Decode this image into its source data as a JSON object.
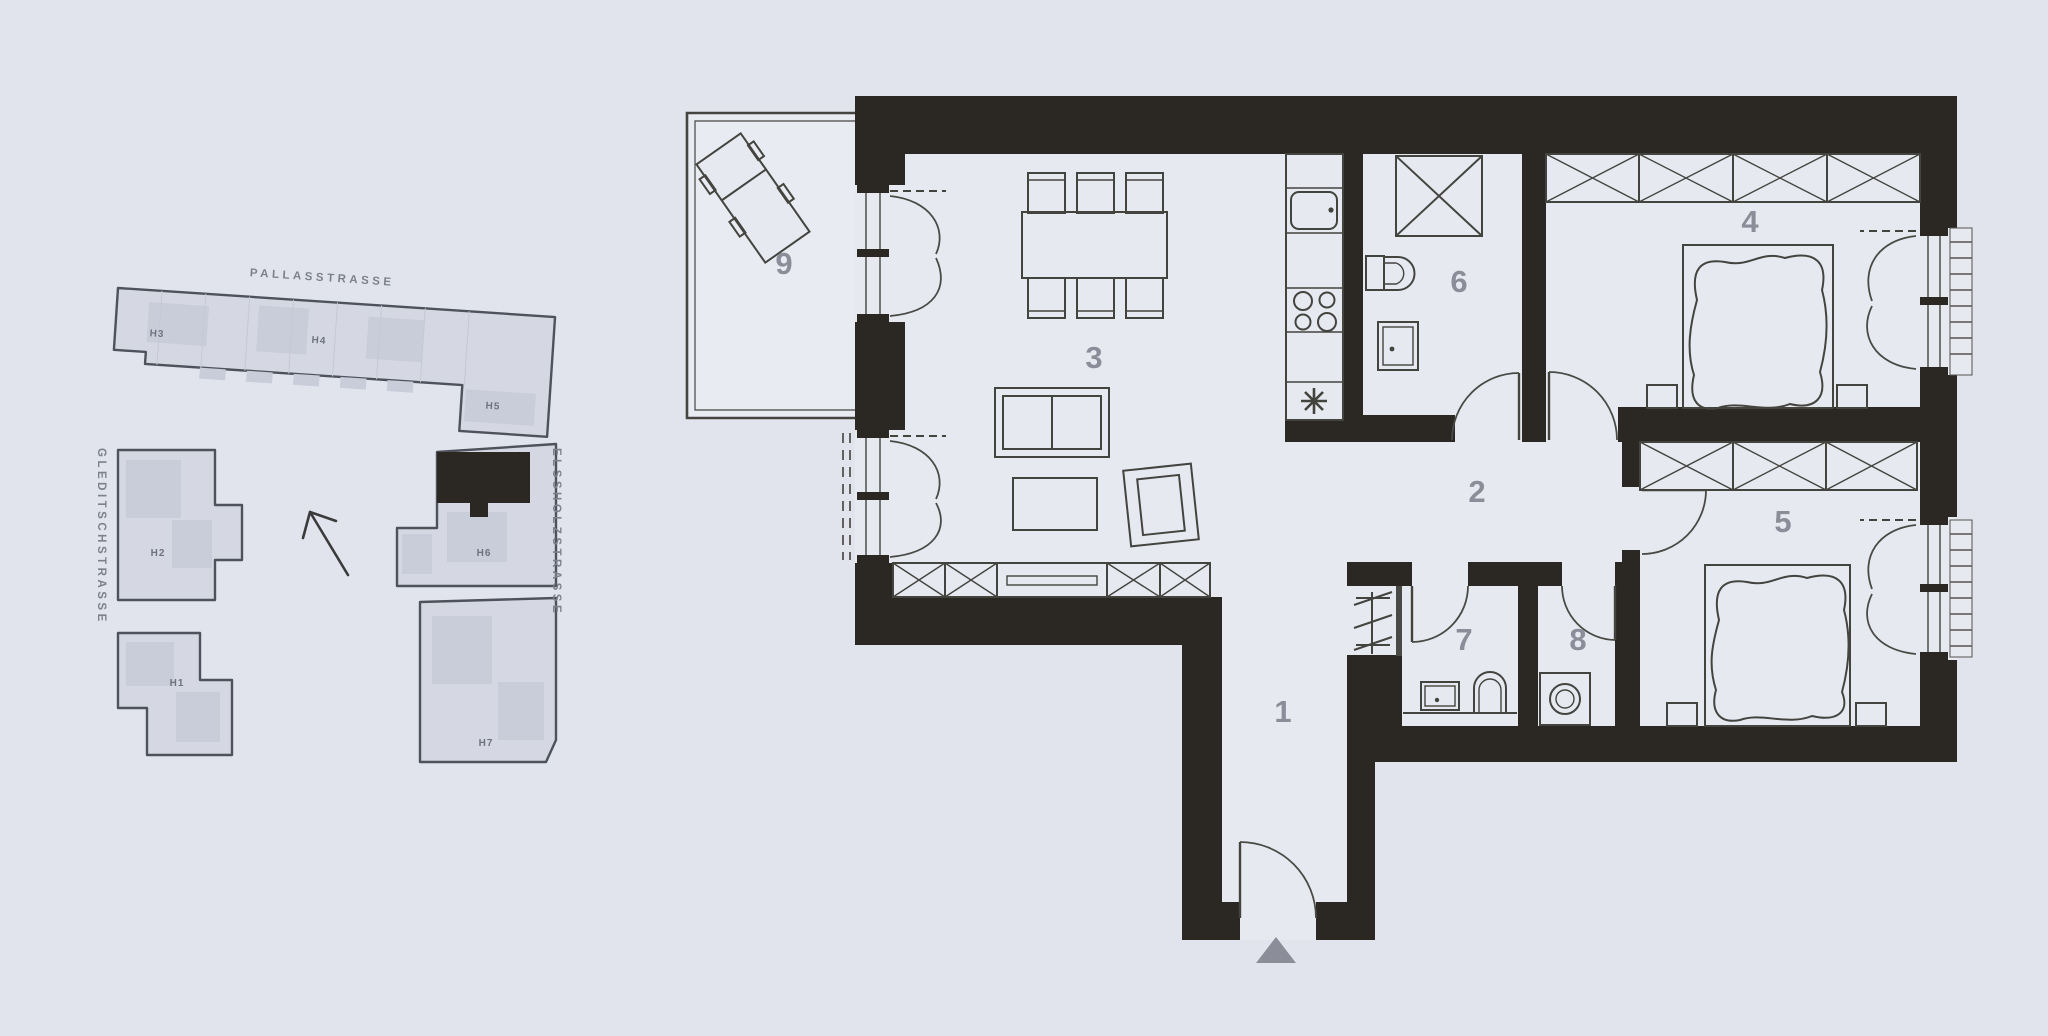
{
  "site_plan": {
    "streets": {
      "top": "PALLASSTRASSE",
      "left": "GLEDITSCHSTRASSE",
      "right": "ELSSHOLZSTRASSE"
    },
    "buildings": [
      {
        "label": "H1"
      },
      {
        "label": "H2"
      },
      {
        "label": "H3"
      },
      {
        "label": "H4"
      },
      {
        "label": "H5"
      },
      {
        "label": "H6"
      },
      {
        "label": "H7"
      }
    ],
    "highlighted_building": "H6",
    "north_arrow_direction": "up-left"
  },
  "floor_plan": {
    "rooms": [
      {
        "number": "1",
        "type": "entrance-hall"
      },
      {
        "number": "2",
        "type": "hallway"
      },
      {
        "number": "3",
        "type": "living-dining"
      },
      {
        "number": "4",
        "type": "bedroom"
      },
      {
        "number": "5",
        "type": "bedroom"
      },
      {
        "number": "6",
        "type": "bathroom"
      },
      {
        "number": "7",
        "type": "wc"
      },
      {
        "number": "8",
        "type": "utility-room"
      },
      {
        "number": "9",
        "type": "balcony"
      }
    ]
  },
  "colors": {
    "background": "#e2e4ed",
    "floor": "#e7e9f1",
    "wall": "#2b2722",
    "furniture_line": "#44443f",
    "label": "#8b8e99",
    "site_fill": "#d5d8e2",
    "site_outline": "#4d525b",
    "site_text": "#7d818c",
    "highlight": "#2b2722"
  }
}
